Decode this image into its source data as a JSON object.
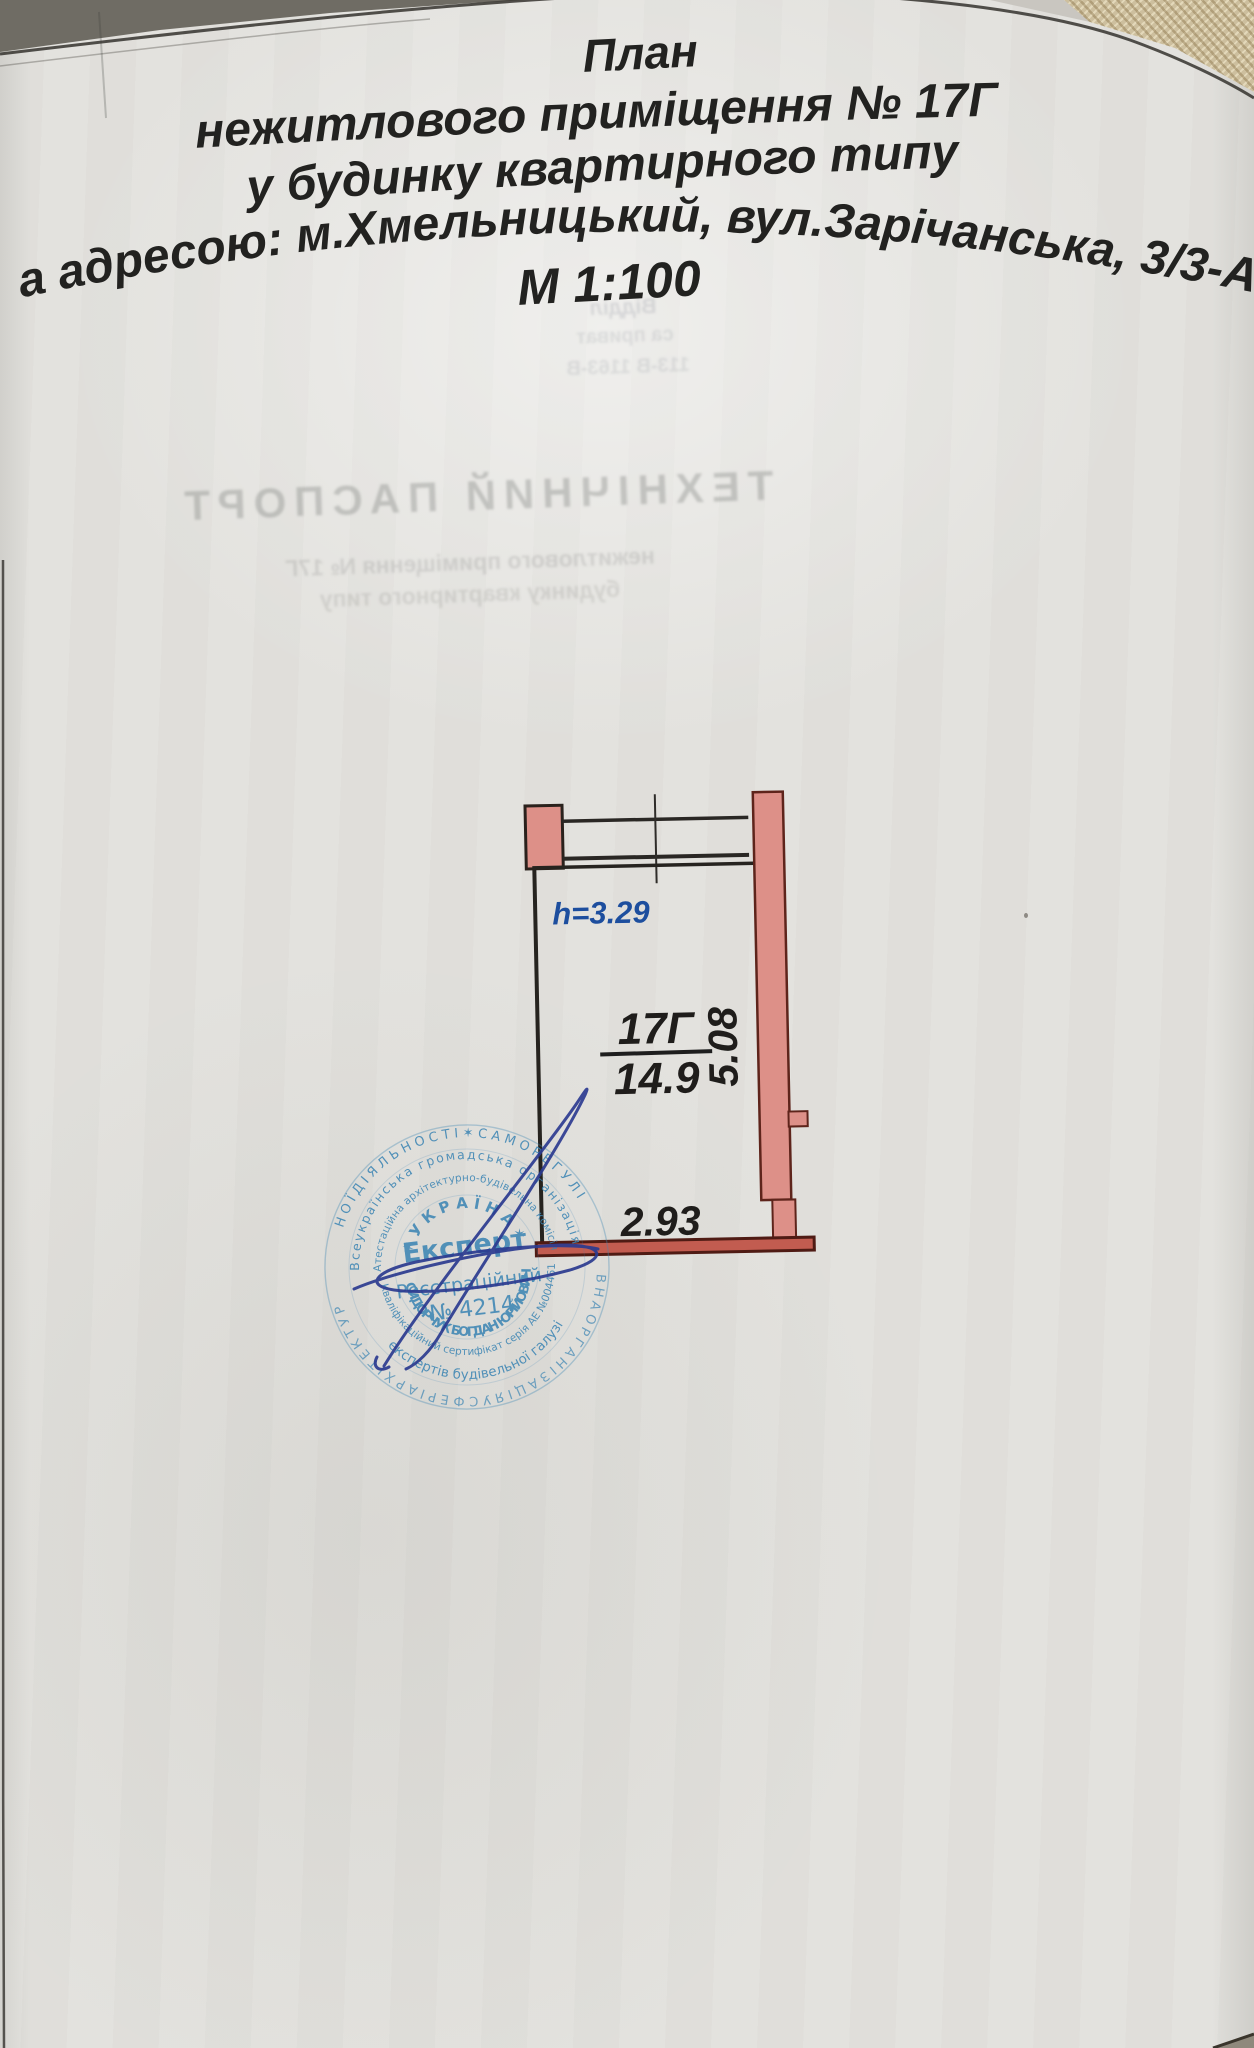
{
  "header": {
    "line1": "План",
    "line2": "нежитлового приміщення № 17Г",
    "line3": "у будинку квартирного типу",
    "line4": "за адресою: м.Хмельницький, вул.Зарічанська, 3/3-А",
    "line5": "М 1:100"
  },
  "plan": {
    "height_label": "h=3.29",
    "room_number": "17Г",
    "area_value": "14.9",
    "dim_width": "2.93",
    "dim_depth": "5.08",
    "colors": {
      "wall_fill": "#dd9088",
      "wall_outline": "#5e241b",
      "dimension_text": "#1f1d1b",
      "height_text": "#1d4e9e"
    }
  },
  "stamp": {
    "ink_color": "#3e86b4",
    "ring_outer_top": "Н О Ї   Д І Я Л Ь Н О С Т І   ✶   С А М О Р Е Г У Л І",
    "ring_outer_bottom": "В Н А   О Р Г А Н І З А Ц І Я   У   С Ф Е Р І   А Р Х І Т Е К Т У Р",
    "ring_middle_top": "Всеукраїнська громадська організація",
    "ring_middle_bottom": "експертів будівельної галузі",
    "ring_inner_top": "Атестаційна архітектурно-будівельна комісія",
    "ring_inner_bottom": "Кваліфікаційний сертифікат серія АЕ №004461",
    "country_arc": "✶ У К Р А Ї Н А ✶",
    "role": "Експерт",
    "registry_label": "Реєстраційний",
    "registry_number": "№ 4214",
    "holder_name": "СИДОРЧУК БОГДАН ЮРІЙОВИЧ"
  },
  "ghost_showthrough": {
    "big_title": "ТЕХНІЧНИЙ ПАСПОРТ",
    "sub_line1": "нежитлового приміщення № 17Г",
    "sub_line2": "будинку квартирного типу",
    "fragment1": "Відділ",
    "fragment2": "са приват",
    "fragment3": "113-В 1163-В"
  }
}
